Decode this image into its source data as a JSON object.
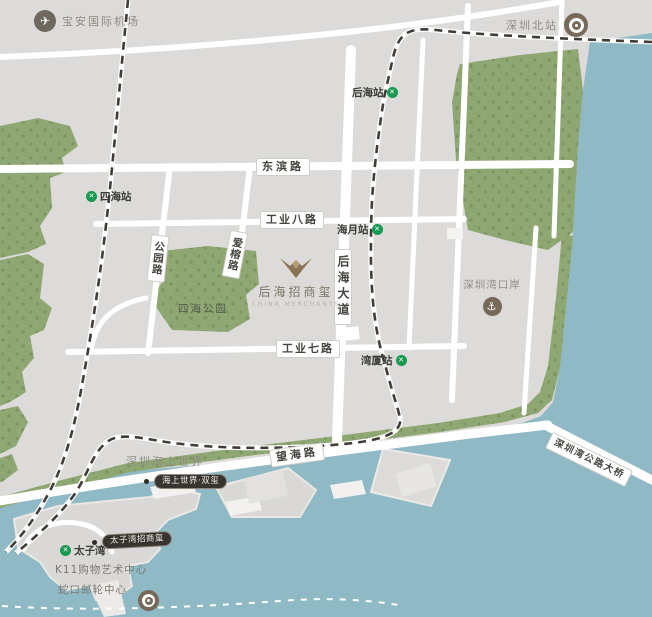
{
  "colors": {
    "water": "#8fb9c5",
    "land": "#dcdbd9",
    "green": "#8fa873",
    "green_dark": "#7c9460",
    "road": "#ffffff",
    "rail": "#403c36",
    "metro_green": "#17994f",
    "poi_brown": "#76685a",
    "badge_bg": "#38342f",
    "label_text": "#45443f",
    "muted_text": "#8f8c82"
  },
  "icons": {
    "metro": "✕",
    "plane": "✈",
    "anchor": "⚓"
  },
  "pois": {
    "airport": "宝安国际机场",
    "north_station": "深圳北站",
    "bay_port": "深圳湾口岸",
    "sihai_park": "四海公园",
    "sea_world_area": "深圳海上世界",
    "sea_world_twin_badge": "海上世界·双玺",
    "prince_bay_badge": "太子湾招商玺",
    "k11": "K11购物艺术中心",
    "shekou_cruise": "蛇口邮轮中心"
  },
  "stations": {
    "sihai": "四海站",
    "houhai": "后海站",
    "haiyue": "海月站",
    "wanxia": "湾厦站",
    "taiziwan": "太子湾"
  },
  "roads": {
    "dongbin": "东滨路",
    "gongye8": "工业八路",
    "gongye7": "工业七路",
    "wanghai": "望海路",
    "houhai_avenue": "后海大道",
    "gongyuan": "公园路",
    "airong": "爱榕路",
    "bridge": "深圳湾公路大桥"
  },
  "logo": {
    "name": "后海招商玺",
    "subtext": "CHINA MERCHANTS"
  }
}
